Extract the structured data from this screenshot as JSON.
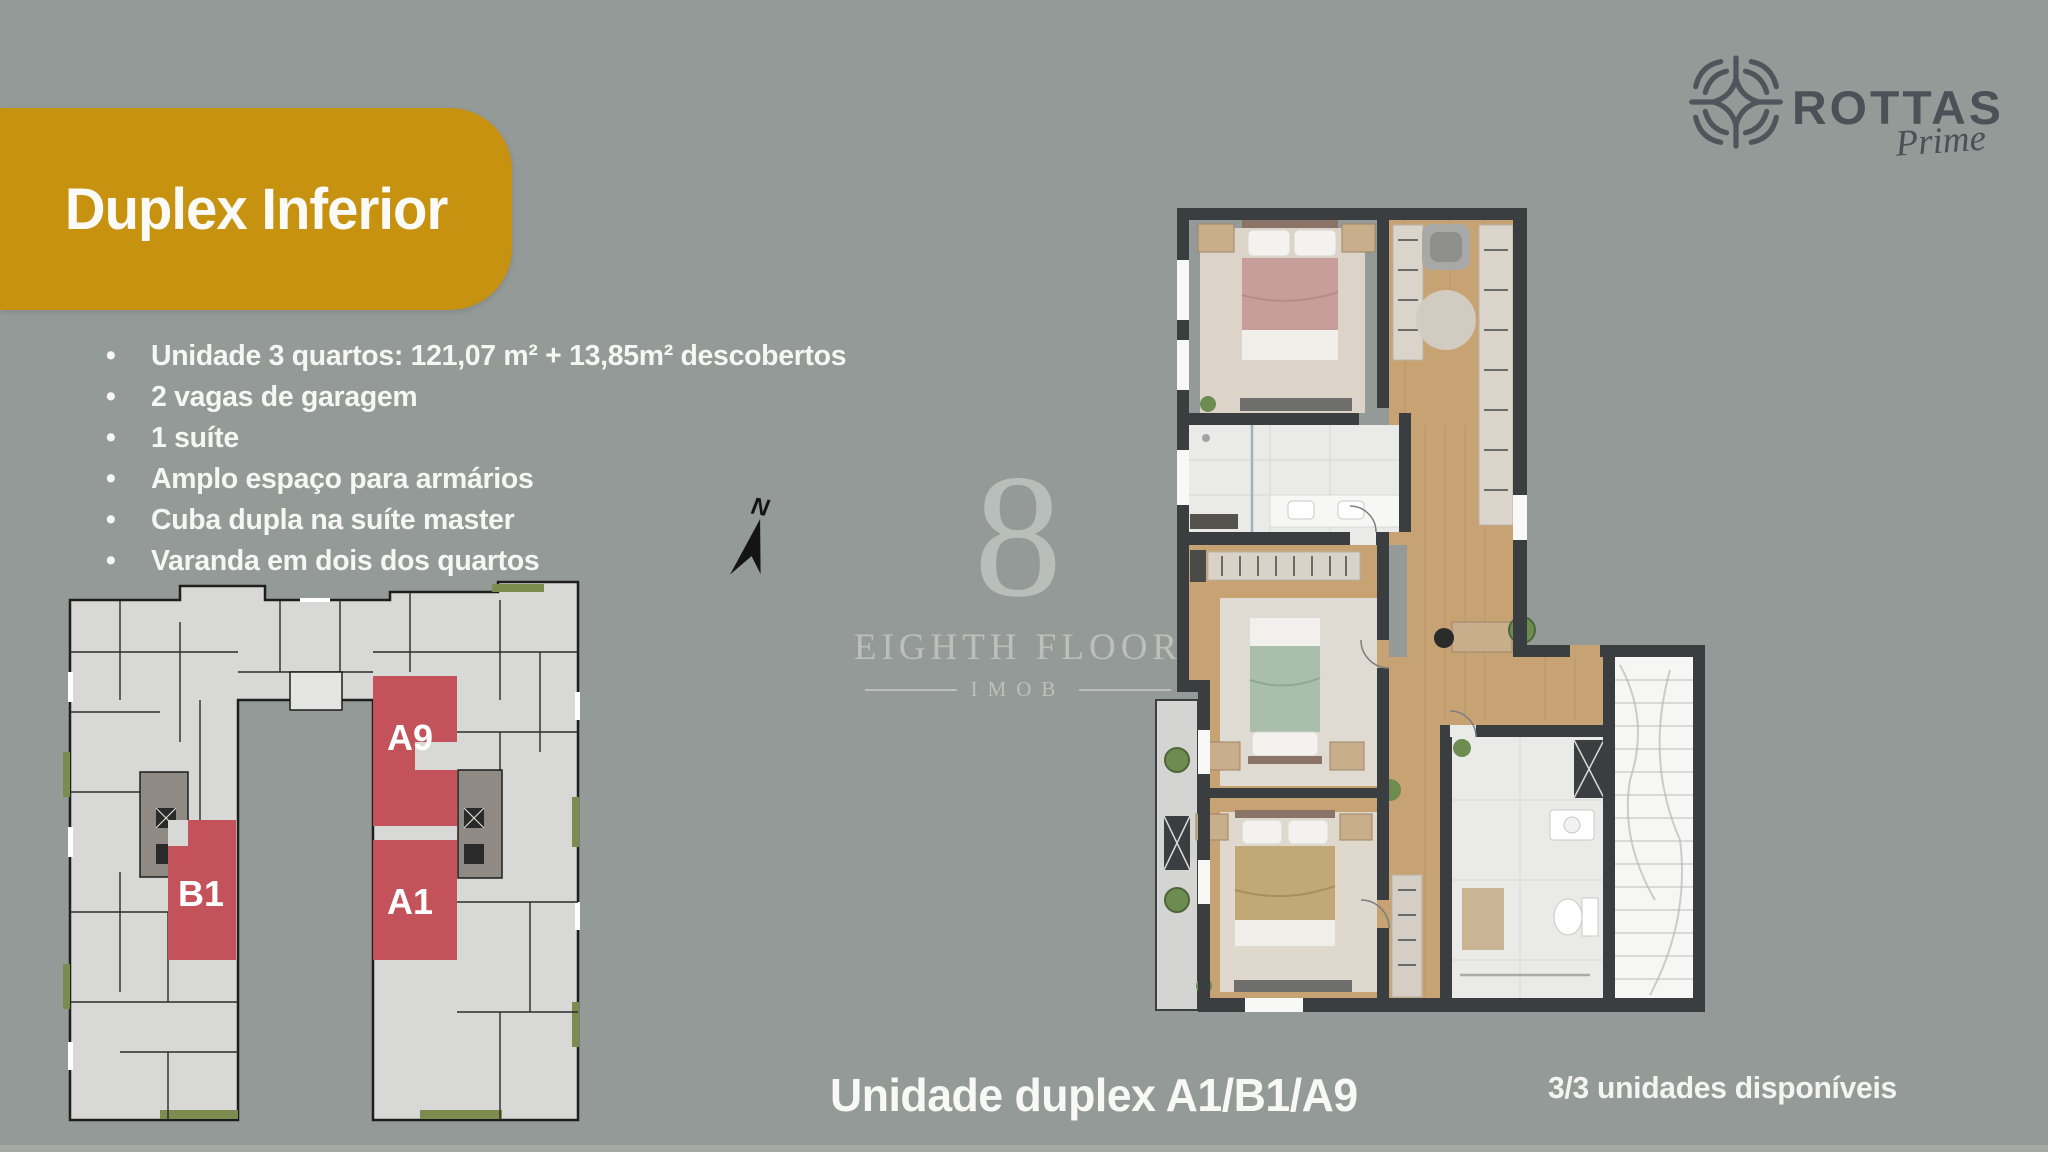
{
  "page": {
    "background_color": "#949A97"
  },
  "banner": {
    "title": "Duplex Inferior",
    "color": "#C6920F"
  },
  "features": {
    "items": [
      "Unidade 3 quartos: 121,07 m² + 13,85m² descobertos",
      "2 vagas de garagem",
      "1 suíte",
      "Amplo espaço para armários",
      "Cuba dupla na suíte master",
      "Varanda em dois dos quartos"
    ]
  },
  "brand": {
    "name": "ROTTAS",
    "tagline": "Prime",
    "color": "#4A5157"
  },
  "watermark": {
    "glyph": "8",
    "title": "EIGHTH FLOOR",
    "subtitle": "IMOB"
  },
  "key_plan": {
    "highlight_color": "#C4525A",
    "units": [
      {
        "id": "A9"
      },
      {
        "id": "B1"
      },
      {
        "id": "A1"
      }
    ]
  },
  "compass": {
    "label": "N"
  },
  "footer": {
    "caption": "Unidade duplex A1/B1/A9",
    "availability": "3/3 unidades disponíveis"
  }
}
